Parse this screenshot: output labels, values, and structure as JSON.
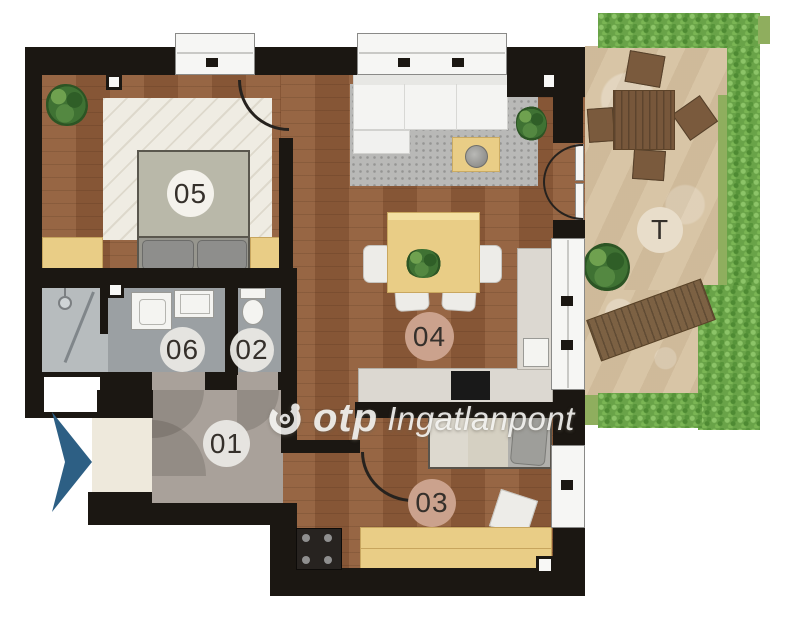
{
  "watermark": {
    "brand": "otp",
    "suffix": "Ingatlanpont"
  },
  "rooms": {
    "r01": "01",
    "r02": "02",
    "r03": "03",
    "r04": "04",
    "r05": "05",
    "r06": "06",
    "terrace": "T"
  },
  "icons": {
    "otp_logo": "otp-logo-icon",
    "entrance_arrow": "entrance-arrow-icon",
    "shower": "shower-head-icon"
  },
  "colors": {
    "wall": "#1b1712",
    "wood": "#8e5c3a",
    "bath": "#9ba0a3",
    "hall": "#a9a19a",
    "entry": "#eee9dc",
    "terrace": "#d8c5a6",
    "hedge": "#69a348",
    "grass": "#8fae5e",
    "furniture_yellow": "#e9cd86",
    "terrace_wood": "#7a5a3d",
    "label_tan": "#cba28d",
    "label_white": "#f4f2ec",
    "arrow": "#2d5f84",
    "text": "#35302b",
    "watermark": "#f5f5f4"
  }
}
